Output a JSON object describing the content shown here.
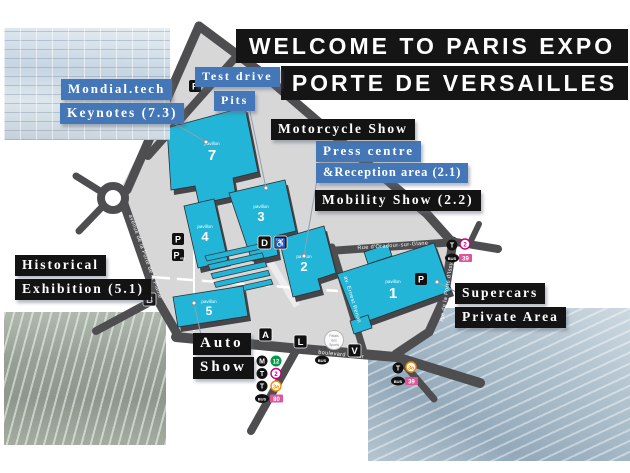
{
  "title": {
    "line1": "WELCOME TO PARIS EXPO",
    "line2": "PORTE DE VERSAILLES"
  },
  "labels": {
    "mondial_tech": "Mondial.tech",
    "keynotes": "Keynotes (7.3)",
    "test_drive": "Test drive",
    "pits": "Pits",
    "motorcycle_show": "Motorcycle Show",
    "press_centre": "Press centre",
    "reception_area": "&Reception area (2.1)",
    "mobility_show": "Mobility Show (2.2)",
    "historical": "Historical",
    "exhibition": "Exhibition (5.1)",
    "supercars": "Supercars",
    "private_area": "Private Area",
    "auto": "Auto",
    "show": "Show"
  },
  "pavilions": {
    "p1": {
      "caption": "pavillon",
      "number": "1"
    },
    "p2": {
      "caption": "pavillon",
      "number": "2"
    },
    "p3": {
      "caption": "pavillon",
      "number": "3"
    },
    "p4": {
      "caption": "pavillon",
      "number": "4"
    },
    "p5": {
      "caption": "pavillon",
      "number": "5"
    },
    "p7": {
      "caption": "pavillon",
      "number": "7"
    }
  },
  "markers": {
    "a": "A",
    "b": "B",
    "d": "D",
    "l": "L",
    "v": "V",
    "parking": "P",
    "parking_vip_suffix": "vip",
    "wheelchair": "♿"
  },
  "streets": {
    "plaine": "avenue de la Porte de la Plaine",
    "oradour": "Rue d'Oradour-sur-Glane",
    "issy": "rue de la Porte d'Issy",
    "renan": "av. Ernest Renan",
    "victor": "boulevard Victor"
  },
  "palais": {
    "l1": "Palais",
    "l2": "des",
    "l3": "Sports"
  },
  "transit": {
    "metro_letter": "M",
    "tram_letter": "T",
    "bus_label": "BUS",
    "metro12": "12",
    "tram2": "2",
    "tram3a": "3a",
    "bus80": "80",
    "bus39": "39",
    "colors": {
      "metro12": "#009a49",
      "tram2": "#c5007c",
      "tram3a": "#ef8b00",
      "bus": "#df549b"
    }
  },
  "colors": {
    "accent_blue": "#4377b8",
    "building_cyan": "#22b5d8",
    "road_gray": "#4e4e50",
    "ground_gray": "#d7d7d8",
    "banner_black": "#151516"
  },
  "photos": {
    "top_left": "exhibition-hall-render",
    "bottom_left": "expo-aerial-photo",
    "bottom_right": "city-aerial-photo"
  }
}
